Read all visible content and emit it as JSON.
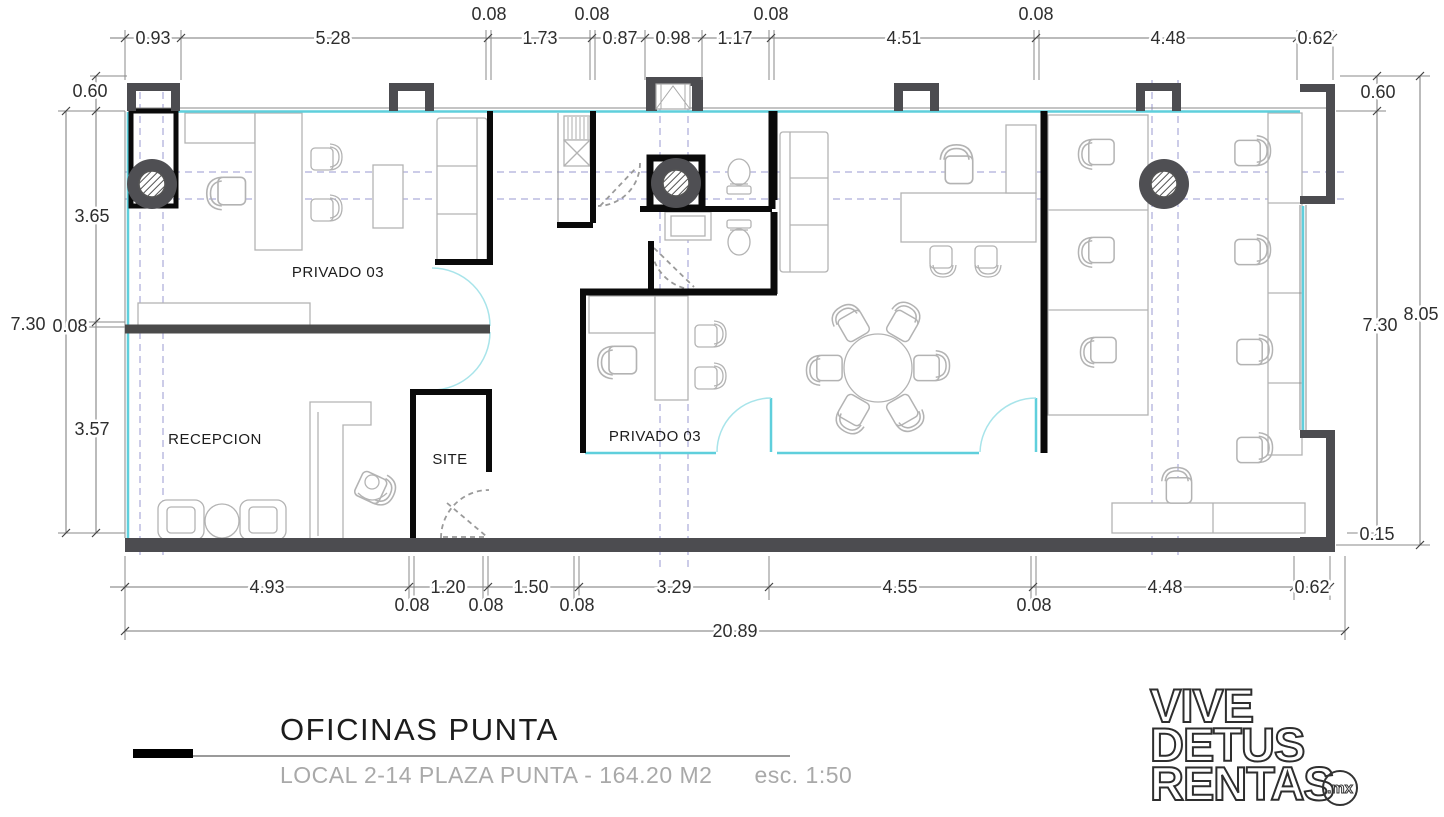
{
  "title_block": {
    "title": "OFICINAS PUNTA",
    "subtitle": "LOCAL 2-14 PLAZA PUNTA - 164.20 M2",
    "scale": "esc. 1:50"
  },
  "logo": {
    "line1": "VIVE",
    "line2": "DETUS",
    "line3": "RENTAS",
    "suffix": ".mx"
  },
  "rooms": {
    "privado_left": "PRIVADO 03",
    "privado_mid": "PRIVADO 03",
    "recepcion": "RECEPCION",
    "site": "SITE"
  },
  "dimensions": {
    "top": [
      "0.93",
      "5.28",
      "0.08",
      "1.73",
      "0.08",
      "0.87",
      "0.98",
      "1.17",
      "0.08",
      "4.51",
      "0.08",
      "4.48",
      "0.62"
    ],
    "bottom": [
      "4.93",
      "0.08",
      "1.20",
      "0.08",
      "1.50",
      "0.08",
      "3.29",
      "4.55",
      "0.08",
      "4.48",
      "0.62"
    ],
    "bottom_total": "20.89",
    "left": {
      "v060": "0.60",
      "v365": "3.65",
      "v008": "0.08",
      "v357": "3.57",
      "total": "7.30"
    },
    "right": {
      "v060": "0.60",
      "v730": "7.30",
      "total": "8.05",
      "v015": "0.15"
    }
  },
  "colors": {
    "wall": "#0a0a0a",
    "structure": "#4c4c50",
    "glass": "#5fcfdc",
    "grid": "#9a9ad2",
    "furniture": "#b3b3b3",
    "dimension_text": "#2e2e2e",
    "subtitle_gray": "#a9a9a9"
  }
}
